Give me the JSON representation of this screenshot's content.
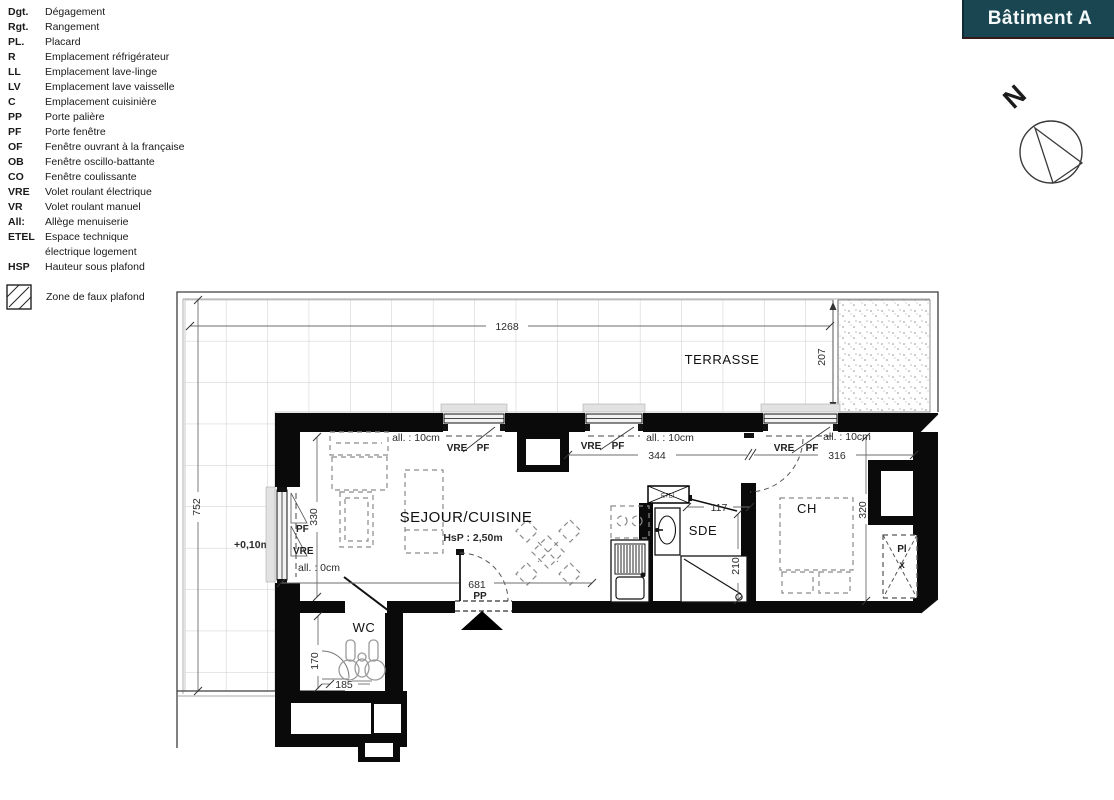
{
  "header": {
    "building": "Bâtiment A"
  },
  "compass": {
    "north": "N"
  },
  "legend": {
    "zone_label": "Zone de faux plafond",
    "items": [
      {
        "abbr": "Dgt.",
        "label": "Dégagement"
      },
      {
        "abbr": "Rgt.",
        "label": "Rangement"
      },
      {
        "abbr": "PL.",
        "label": "Placard"
      },
      {
        "abbr": "R",
        "label": "Emplacement réfrigérateur"
      },
      {
        "abbr": "LL",
        "label": "Emplacement lave-linge"
      },
      {
        "abbr": "LV",
        "label": "Emplacement lave vaisselle"
      },
      {
        "abbr": "C",
        "label": "Emplacement cuisinière"
      },
      {
        "abbr": "PP",
        "label": "Porte palière"
      },
      {
        "abbr": "PF",
        "label": "Porte fenêtre"
      },
      {
        "abbr": "OF",
        "label": "Fenêtre ouvrant à la française"
      },
      {
        "abbr": "OB",
        "label": "Fenêtre oscillo-battante"
      },
      {
        "abbr": "CO",
        "label": "Fenêtre coulissante"
      },
      {
        "abbr": "VRE",
        "label": "Volet roulant électrique"
      },
      {
        "abbr": "VR",
        "label": "Volet roulant manuel"
      },
      {
        "abbr": "All:",
        "label": "Allège menuiserie"
      },
      {
        "abbr": "ETEL",
        "label": "Espace technique",
        "label2": "électrique logement"
      },
      {
        "abbr": "HSP",
        "label": "Hauteur sous plafond"
      }
    ]
  },
  "plan": {
    "level": "+0,10m",
    "rooms": {
      "terrasse": "TERRASSE",
      "sejour": "SEJOUR/CUISINE",
      "hsp": "HsP : 2,50m",
      "sde": "SDE",
      "ch": "CH",
      "wc": "WC",
      "pl": "Pl",
      "pl_x": "x",
      "etel": "ETEL"
    },
    "dims": {
      "total_width": "1268",
      "terrace_depth": "207",
      "terrace_height": "752",
      "sejour_width": "681",
      "left_bay": "330",
      "win_left": "344",
      "win_right": "316",
      "ch_depth": "320",
      "sde_width": "117",
      "sde_depth": "210",
      "wc_depth": "170",
      "wc_width": "185"
    },
    "openings": {
      "vre": "VRE",
      "pf": "PF",
      "pp": "PP",
      "allege_10": "all. : 10cm",
      "allege_0": "all. : 0cm"
    }
  },
  "colors": {
    "banner": "#1a4652",
    "wall": "#0a0a0a",
    "tile_grid": "#cdcdcd",
    "furniture_dash": "#8a8a8a"
  }
}
